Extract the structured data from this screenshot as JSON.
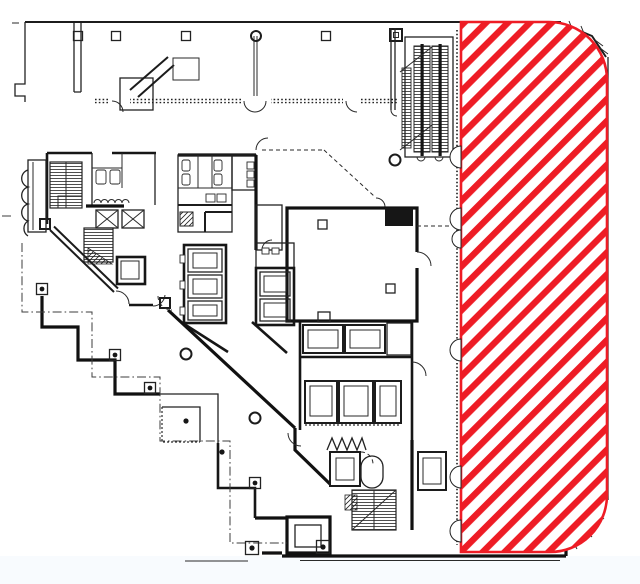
{
  "document": {
    "type": "architectural-floor-plan",
    "background": "#ffffff",
    "footer_tint": "#f8fbfe",
    "visible_text": ""
  },
  "floorplan": {
    "ink_color": "#1c1c1c",
    "features": [
      "north-wing-band",
      "column-grid-markers",
      "escalator-bank",
      "restrooms",
      "stair-cores",
      "elevator-banks",
      "large-room",
      "stepped-site-boundary",
      "door-swing-arcs",
      "chamfered-right-facade"
    ]
  },
  "highlight": {
    "name": "hatched-availability-area",
    "pattern": "diagonal-stripes",
    "stripe_color": "#ee1c25",
    "stripe_background": "#ffffff",
    "outline_color": "#ee1c25",
    "stripe_period_px": 15.5,
    "stripe_width_px": 6.4,
    "corner_style": "rounded-right-corners"
  }
}
